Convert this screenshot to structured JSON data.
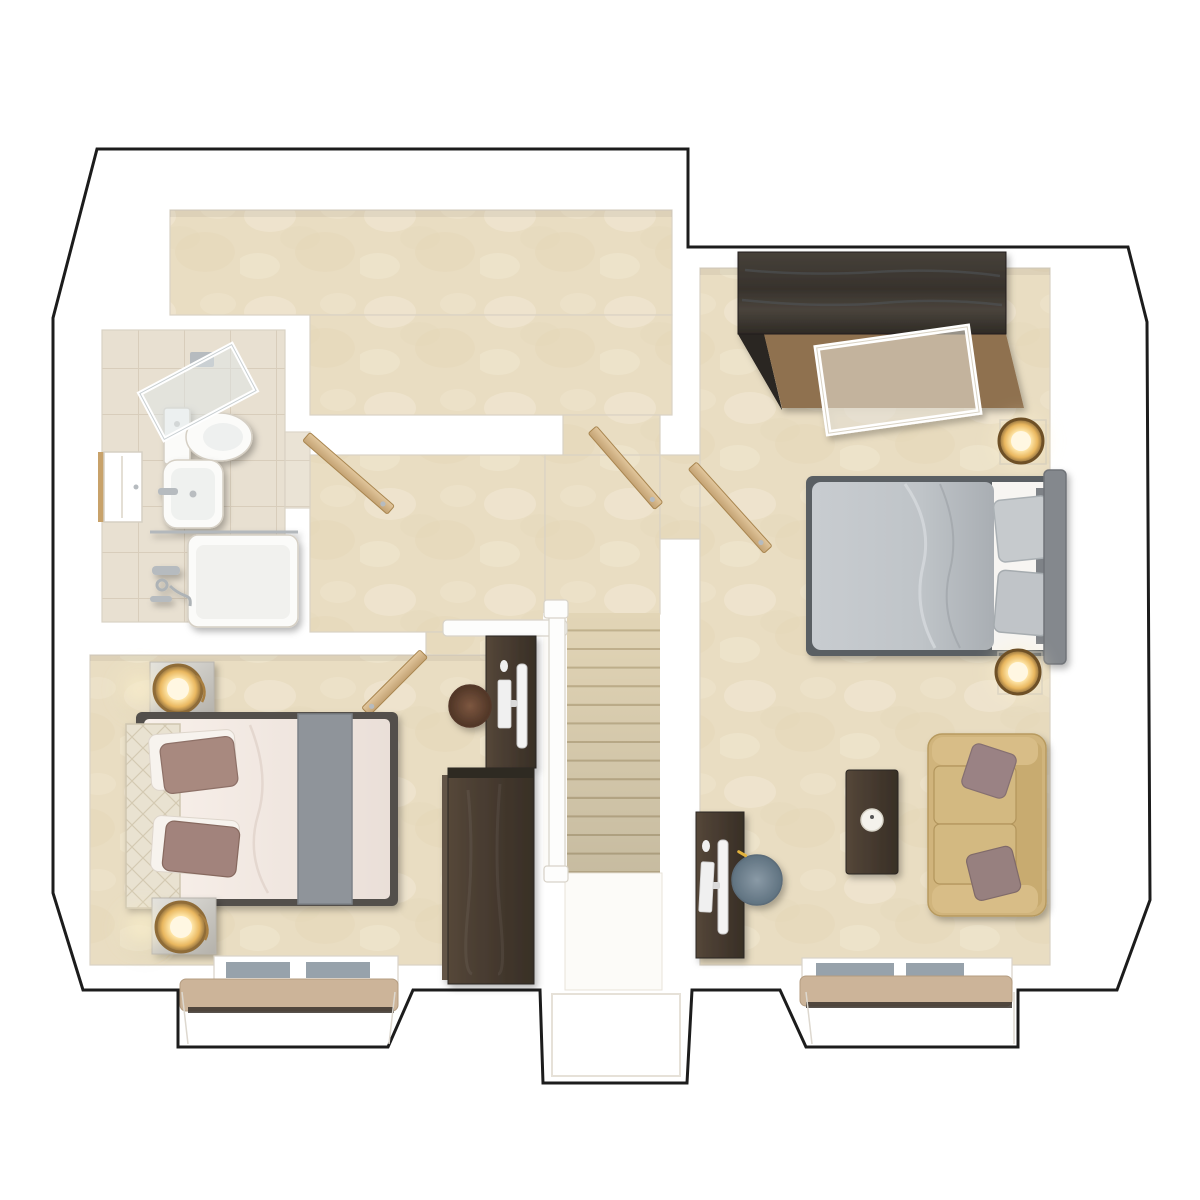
{
  "meta": {
    "title": "First floor 3D floor plan render",
    "view": "top-down dollhouse",
    "visible_text": "none"
  },
  "colors": {
    "outline": "#1c1c1c",
    "wallEdge": "#d9d2c4",
    "carpet": "#e9ddc2",
    "carpetLight": "#f4ecda",
    "carpetDark": "#ddcfae",
    "tileFloor": "#e8e0d1",
    "tileLine": "#d8cdbb",
    "stairTread": "#e2d5b6",
    "stairRiser": "#c2b28e",
    "glassPane": "#97a2ab",
    "cushionTan": "#ccb499",
    "sofa": "#d0b47c",
    "sofaLine": "#b2955c",
    "sofaPillow": "#9a8284",
    "duvetGray": "#bfc4c8",
    "headboardGray": "#84888d",
    "duvetBlush": "#f5ebe6",
    "runnerGray": "#8f949a",
    "pillowMauve": "#a8897f",
    "headboardCream": "#e9e2d1",
    "brass": "#96743f",
    "glow": "#ffefc0",
    "chairBrown": "#6d4b36",
    "chairBlue": "#72838f",
    "doorWood": "#d6b98e",
    "candleWhite": "#f4f2ec"
  },
  "rooms": [
    {
      "id": "landing",
      "name": "landing",
      "floor": "beige carpet"
    },
    {
      "id": "bathroom",
      "name": "bathroom",
      "floor": "stone tiles",
      "furniture": [
        "shower enclosure",
        "toilet",
        "wash basin",
        "bath with shower fittings",
        "wall cabinet with mirror"
      ]
    },
    {
      "id": "bedroom-right",
      "name": "bedroom 1",
      "floor": "beige carpet",
      "furniture": [
        "double wardrobe (dark wood, door open)",
        "double bed (gray bedding)",
        "two bedside lamps (lit)",
        "two-seat sofa (tan) with two cushions",
        "side table with candle",
        "computer desk with monitor and keyboard",
        "desk chair (blue-gray)",
        "bay window with seat cushion"
      ]
    },
    {
      "id": "bedroom-left",
      "name": "bedroom 2",
      "floor": "beige carpet",
      "furniture": [
        "double bed (blush bedding, gray runner, quilted headboard)",
        "two bedside cabinets with lit lamps",
        "wardrobe (dark wood)",
        "computer desk with monitor and keyboard",
        "desk chair (brown)",
        "bay window with seat cushion"
      ]
    },
    {
      "id": "stairwell",
      "name": "staircase",
      "floor": "carpeted treads",
      "details": [
        "white handrail on left",
        "white banister at top",
        "lower white landing with bay"
      ]
    }
  ],
  "doors": [
    {
      "room": "bathroom",
      "state": "open"
    },
    {
      "room": "bedroom-left",
      "state": "open"
    },
    {
      "room": "bedroom-right",
      "state": "open"
    },
    {
      "room": "stairwell",
      "state": "open"
    }
  ],
  "stairs": {
    "count": 14,
    "x": 567,
    "y": 613,
    "width": 93,
    "tread_height": 18.6
  },
  "windows": [
    {
      "room": "bedroom-left",
      "type": "bay",
      "panes": 2,
      "seat": true
    },
    {
      "room": "bedroom-right",
      "type": "bay",
      "panes": 2,
      "seat": true
    },
    {
      "room": "stairwell",
      "type": "bay",
      "panes": 0,
      "seat": false
    }
  ]
}
